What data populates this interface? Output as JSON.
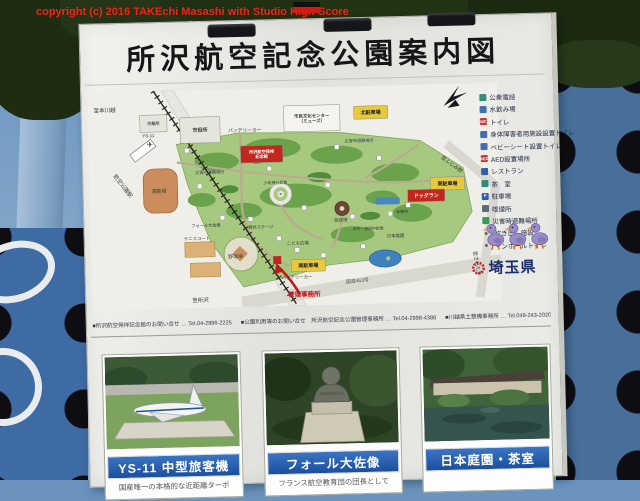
{
  "watermark": {
    "text": "copyright (c) 2016 TAKEchi Masashi with Studio High-Score"
  },
  "board": {
    "title": "所沢航空記念公園案内図"
  },
  "map": {
    "boxes": [
      {
        "t": "市役所",
        "x": 92,
        "y": 27,
        "w": 40,
        "h": 26,
        "f": "#e6e5dd",
        "tc": "#333",
        "fs": 5
      },
      {
        "t": "作業所",
        "x": 52,
        "y": 24,
        "w": 27,
        "h": 17,
        "f": "#e6e5dd",
        "tc": "#555",
        "fs": 4.2
      },
      {
        "t": "市民文化センター\n（ミューズ）",
        "x": 196,
        "y": 18,
        "w": 56,
        "h": 26,
        "f": "#f5f4ef",
        "tc": "#333",
        "fs": 4.4
      },
      {
        "t": "北駐車場",
        "x": 266,
        "y": 20,
        "w": 34,
        "h": 13,
        "f": "#e8c93e",
        "tc": "#222",
        "fs": 5
      },
      {
        "t": "東駐車場",
        "x": 341,
        "y": 93,
        "w": 34,
        "h": 13,
        "f": "#e8c93e",
        "tc": "#222",
        "fs": 5
      },
      {
        "t": "南駐車場",
        "x": 200,
        "y": 172,
        "w": 34,
        "h": 12,
        "f": "#e8c93e",
        "tc": "#222",
        "fs": 5
      },
      {
        "t": "ドッグラン",
        "x": 318,
        "y": 105,
        "w": 37,
        "h": 12,
        "f": "#c0281e",
        "tc": "#fff",
        "fs": 5
      },
      {
        "t": "所沢航空発祥\n記念館",
        "x": 152,
        "y": 57,
        "w": 42,
        "h": 17,
        "f": "#c0281e",
        "tc": "#fff",
        "fs": 4.2
      }
    ],
    "labels": [
      {
        "t": "至本川越",
        "x": 6,
        "y": 20,
        "fs": 5.5,
        "c": "#333"
      },
      {
        "t": "航空公園駅",
        "x": 24,
        "y": 84,
        "fs": 5.5,
        "c": "#333",
        "r": 54
      },
      {
        "t": "至所沢",
        "x": 100,
        "y": 212,
        "fs": 5.5,
        "c": "#333"
      },
      {
        "t": "YS-11",
        "x": 54,
        "y": 46,
        "fs": 4.5,
        "c": "#333"
      },
      {
        "t": "✈",
        "x": 58,
        "y": 56,
        "fs": 8,
        "c": "#3a3a3a"
      },
      {
        "t": "バッテリーカー",
        "x": 140,
        "y": 43,
        "fs": 4.8,
        "c": "#333"
      },
      {
        "t": "災害時避難場所",
        "x": 256,
        "y": 56,
        "fs": 4.2,
        "c": "#445"
      },
      {
        "t": "災害時避難場所",
        "x": 106,
        "y": 84,
        "fs": 4.2,
        "c": "#445"
      },
      {
        "t": "運動場",
        "x": 62,
        "y": 102,
        "fs": 5,
        "c": "#35482c"
      },
      {
        "t": "テニスコート",
        "x": 93,
        "y": 150,
        "fs": 4.4,
        "c": "#35482c"
      },
      {
        "t": "野球場",
        "x": 137,
        "y": 169,
        "fs": 5,
        "c": "#35482c"
      },
      {
        "t": "少年飛行兵像",
        "x": 174,
        "y": 96,
        "fs": 4,
        "c": "#333"
      },
      {
        "t": "フォール大佐像",
        "x": 101,
        "y": 137,
        "fs": 4.2,
        "c": "#333"
      },
      {
        "t": "野外ステージ",
        "x": 158,
        "y": 140,
        "fs": 4.2,
        "c": "#333"
      },
      {
        "t": "こども広場",
        "x": 196,
        "y": 157,
        "fs": 4.4,
        "c": "#333"
      },
      {
        "t": "放送塔",
        "x": 244,
        "y": 135,
        "fs": 4.4,
        "c": "#333"
      },
      {
        "t": "木村・徳田中尉像",
        "x": 262,
        "y": 144,
        "fs": 3.9,
        "c": "#333"
      },
      {
        "t": "日本庭園",
        "x": 296,
        "y": 152,
        "fs": 4.4,
        "c": "#333"
      },
      {
        "t": "休憩所",
        "x": 306,
        "y": 128,
        "fs": 4,
        "c": "#333"
      },
      {
        "t": "バッテリーカー",
        "x": 190,
        "y": 191,
        "fs": 4.4,
        "c": "#333"
      },
      {
        "t": "管理事務所",
        "x": 196,
        "y": 209,
        "fs": 6.5,
        "c": "#c0181c",
        "w": "bold"
      },
      {
        "t": "国道463号",
        "x": 254,
        "y": 197,
        "fs": 5,
        "c": "#555",
        "r": -4
      },
      {
        "t": "至ふじみ野",
        "x": 352,
        "y": 74,
        "fs": 5,
        "c": "#333",
        "r": 38
      },
      {
        "t": "至さいたま",
        "x": 382,
        "y": 168,
        "fs": 5,
        "c": "#333",
        "r": 80
      }
    ]
  },
  "legend": {
    "items": [
      {
        "icon": "public-phone",
        "color": "#2f8f7a",
        "label": "公衆電話"
      },
      {
        "icon": "drinking-fountain",
        "color": "#3f6fb4",
        "label": "水飲み場"
      },
      {
        "icon": "toilet",
        "color": "#c43b36",
        "letter": "WC",
        "label": "トイレ"
      },
      {
        "icon": "accessible-toilet",
        "color": "#3f6fb4",
        "label": "身体障害者用施設設置トイレ"
      },
      {
        "icon": "baby-seat-toilet",
        "color": "#3f6fb4",
        "label": "ベビーシート設置トイレ"
      },
      {
        "icon": "aed",
        "color": "#c43b36",
        "letter": "AED",
        "label": "AED設置場所"
      },
      {
        "icon": "restaurant",
        "color": "#2f5fa8",
        "label": "レストラン"
      },
      {
        "icon": "tea-room",
        "color": "#2f8f7a",
        "label": "茶　室"
      },
      {
        "icon": "parking",
        "color": "#2f5fa8",
        "letter": "P",
        "label": "駐車場"
      },
      {
        "icon": "smoking-area",
        "color": "#5a6b7a",
        "label": "喫煙所"
      },
      {
        "icon": "evacuation-site",
        "color": "#2f9e4f",
        "label": "災害時避難場所"
      },
      {
        "icon": "emergency-cooking",
        "dot": true,
        "label": "炊き出し施設"
      },
      {
        "icon": "manhole-toilet",
        "dot": true,
        "label": "マンホールトイレ"
      }
    ]
  },
  "prefecture": {
    "name": "埼玉県"
  },
  "contacts": [
    "■所沢航空発祥記念館のお問い合せ … Tel.04-2996-2225",
    "■公園利用等のお問い合せ　所沢航空記念公園管理事務所 … Tel.04-2998-4388",
    "■川越県土整備事務所 … Tel.049-243-2020"
  ],
  "photos": [
    {
      "caption": "YS-11 中型旅客機",
      "desc": "国産唯一の本格的な近距離ターボ"
    },
    {
      "caption": "フォール大佐像",
      "desc": "フランス航空教育団の団長として"
    },
    {
      "caption": "日本庭園・茶室",
      "desc": ""
    }
  ]
}
